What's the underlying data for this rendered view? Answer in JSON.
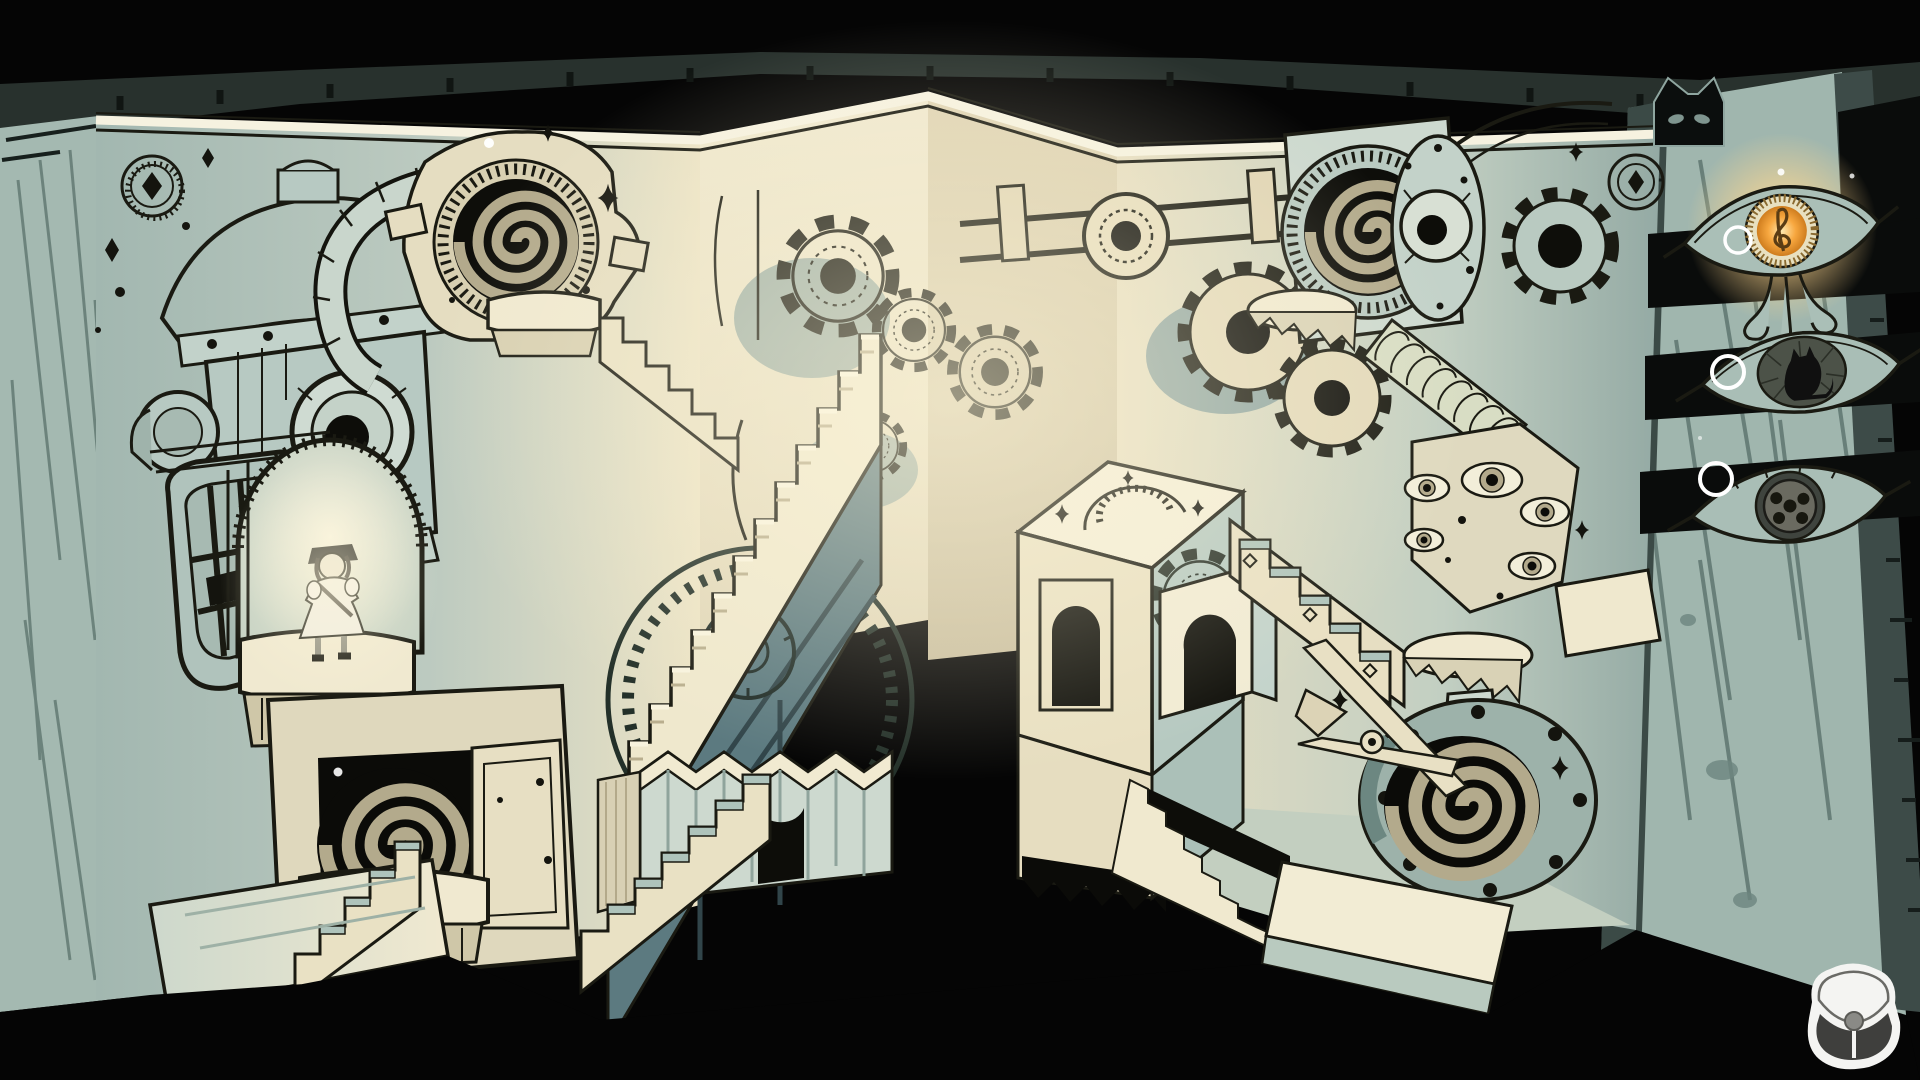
{
  "app": {
    "title": "Pop-up book puzzle game scene",
    "view": "paper diorama level with impossible staircases and clockwork drawings"
  },
  "hud": {
    "cat_tab": {
      "icon": "cat-head-tab",
      "state": "closed",
      "color": "#0b0e0d"
    },
    "goal_slots": [
      {
        "id": "slot-music",
        "icon": "eye-emblem-treble-clef",
        "state": "lit",
        "glow_color": "#f7a940",
        "marker": "ring-marker"
      },
      {
        "id": "slot-cat",
        "icon": "eye-emblem-cat",
        "state": "unlit",
        "glow_color": "",
        "marker": "ring-marker"
      },
      {
        "id": "slot-gear",
        "icon": "eye-emblem-gear-hub",
        "state": "unlit",
        "glow_color": "",
        "marker": "ring-marker"
      }
    ],
    "bag_button": {
      "icon": "satchel-bag",
      "color": "#ffffff"
    }
  },
  "scene": {
    "character": "small girl in white dress standing on alcove ledge",
    "elements": [
      "left page edge stack",
      "right page edge stack",
      "book cover top bevel",
      "robot hydrant head drawing",
      "lantern window",
      "arched alcove",
      "spiral doorway cabinet",
      "top-left spiral disc",
      "grand zigzag staircase",
      "teal truss with medallion",
      "wall gears",
      "pipe rail",
      "central cube platform",
      "floating arch piece",
      "cube-side steps",
      "accordion fold wall",
      "sawtooth steps",
      "top-right spiral disc",
      "eyeball plate",
      "gear ring",
      "ribbed ramp",
      "eye cluster plate",
      "scissor arm",
      "bottom-right spiral disc",
      "zigzag pedestal",
      "white ledges",
      "ink sparkles",
      "white dust motes"
    ]
  },
  "palette": {
    "void_black": "#050505",
    "cover_bevel": "#28312d",
    "page_edge": "#9fb5ad",
    "page_streak": "#5f7670",
    "wall_shadow_teal": "#a9beb7",
    "wall_cream": "#e9e0c2",
    "paper_bright": "#f6f0da",
    "structure_teal": "#5c7a80",
    "step_tread_teal": "#aec3bb",
    "ink": "#1a1a12",
    "spiral_tan": "#b3aa8c",
    "glow_orange": "#f7a73f",
    "glow_warm_light": "#ffe3ae",
    "ui_ring_white": "#ffffff"
  }
}
